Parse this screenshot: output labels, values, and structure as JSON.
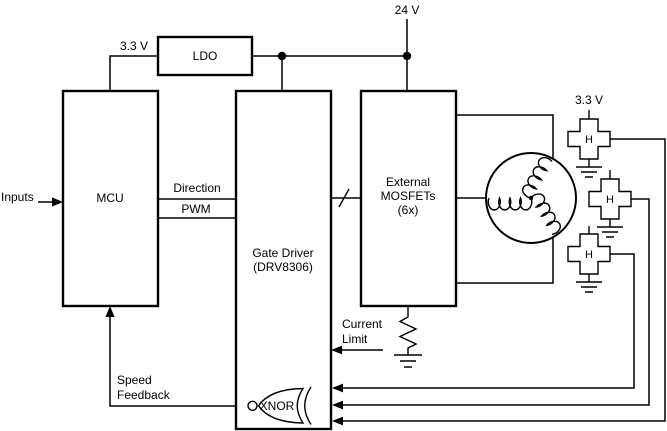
{
  "diagram": {
    "supplies": {
      "bus_24v": "24 V",
      "ldo_output_33v": "3.3 V",
      "hall_supply_33v": "3.3 V"
    },
    "blocks": {
      "mcu": {
        "label": "MCU"
      },
      "ldo": {
        "label": "LDO"
      },
      "gate_driver": {
        "line1": "Gate Driver",
        "line2": "(DRV8306)"
      },
      "external_mosfets": {
        "line1": "External",
        "line2": "MOSFETs",
        "line3": "(6x)"
      }
    },
    "signals": {
      "inputs": "Inputs",
      "direction": "Direction",
      "pwm": "PWM",
      "current_limit_line1": "Current",
      "current_limit_line2": "Limit",
      "speed_feedback_line1": "Speed",
      "speed_feedback_line2": "Feedback"
    },
    "logic": {
      "xnor_label": "XNOR"
    },
    "hall_sensors": {
      "label": "H",
      "count": 3
    },
    "colors": {
      "stroke": "#000000",
      "background": "#ffffff"
    }
  }
}
